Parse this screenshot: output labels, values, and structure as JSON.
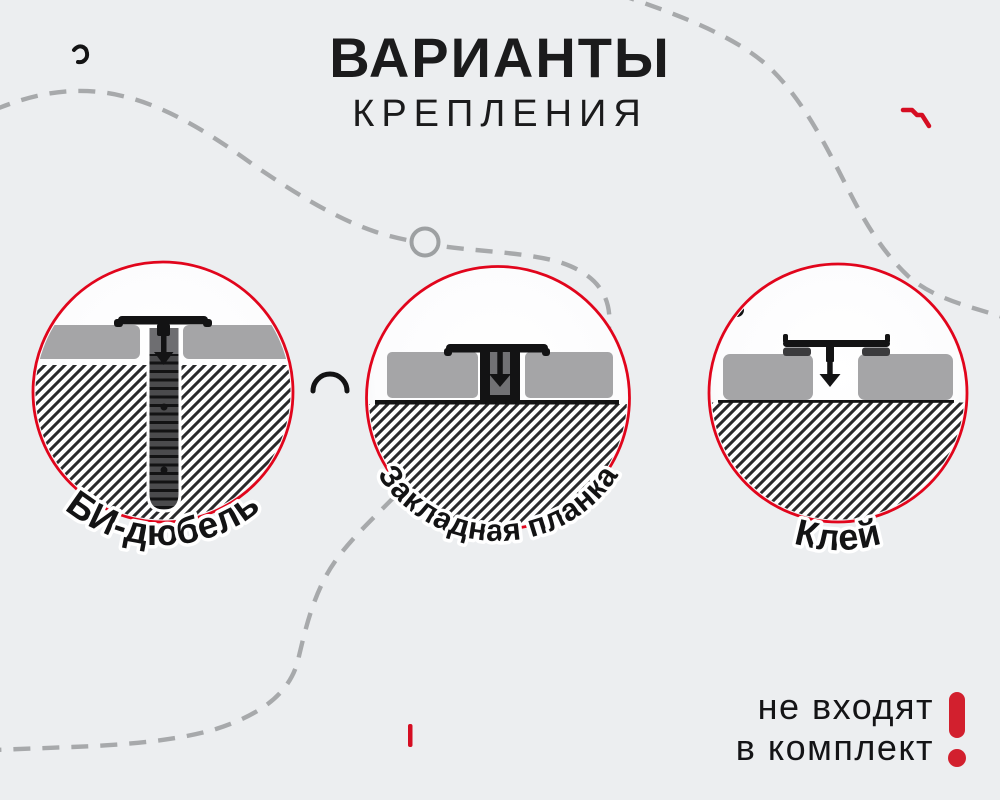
{
  "header": {
    "title_line1": "ВАРИАНТЫ",
    "title_line2": "КРЕПЛЕНИЯ"
  },
  "options": [
    {
      "label": "БИ-дюбель"
    },
    {
      "label": "Закладная планка"
    },
    {
      "label": "Клей"
    }
  ],
  "note": {
    "line1": "не входят",
    "line2": "в комплект",
    "icon": "exclamation-icon"
  },
  "icons": {
    "warning": "exclamation-icon",
    "arrows": "arrow-down-icon",
    "decorations": [
      "dashed-curve",
      "node-circle-icon",
      "comma-squiggle-icon",
      "red-squiggle-icon",
      "small-arc-icon",
      "red-tick-icon",
      "small-circle-icon"
    ]
  },
  "colors": {
    "background": "#eceef0",
    "accent_red": "#e1051c",
    "warning_red": "#d2202e",
    "panel_gray": "#a5a5a7",
    "ink": "#131314",
    "dash_gray": "#a7a9ab"
  }
}
